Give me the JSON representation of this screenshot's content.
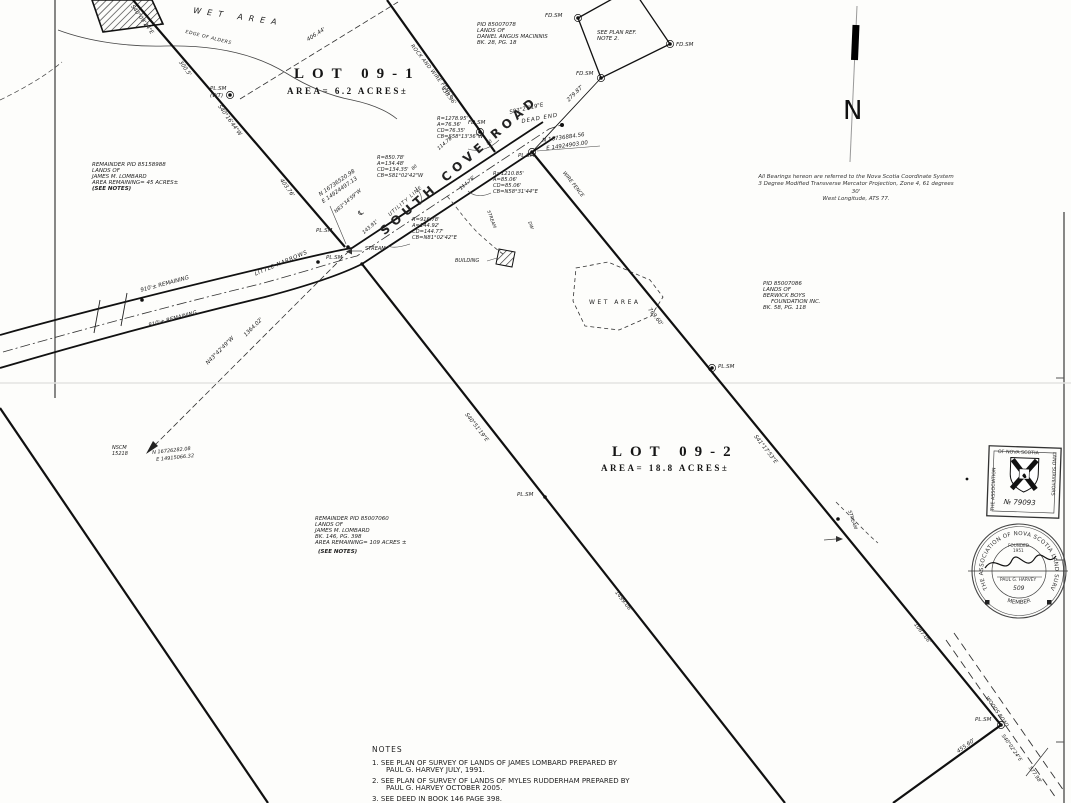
{
  "map": {
    "north_letter": "N",
    "road_name": "SOUTH  COVE  ROAD",
    "centerline_symbol": "℄",
    "lot1": {
      "title": "LOT 09-1",
      "area": "AREA= 6.2 ACRES±"
    },
    "lot2": {
      "title": "LOT 09-2",
      "area": "AREA= 18.8 ACRES±"
    }
  },
  "parcels": {
    "macinnis": [
      "PID 85007078",
      "LANDS OF",
      "DANIEL ANGUS MACINNIS",
      "BK. 28, PG. 18"
    ],
    "see_plan_ref": [
      "SEE PLAN REF.",
      "NOTE 2."
    ],
    "lombard_west": [
      "REMAINDER PID 85158988",
      "LANDS OF",
      "JAMES M. LOMBARD",
      "AREA REMAINING= 45 ACRES±",
      "(SEE NOTES)"
    ],
    "berwick": [
      "PID 85007086",
      "LANDS OF",
      "BERWICK BOYS",
      "FOUNDATION INC.",
      "BK. 58, PG. 118"
    ],
    "lombard_south": [
      "REMAINDER PID 85007060",
      "LANDS OF",
      "JAMES M. LOMBARD",
      "BK. 146, PG. 398",
      "AREA REMAINING= 109 ACRES ±",
      "(SEE NOTES)"
    ]
  },
  "curves": {
    "c1": [
      "R=1278.95'",
      "A=76.36'",
      "CD=76.35'",
      "CB=S58°13'36\"W"
    ],
    "c2": [
      "R=850.78'",
      "A=134.48'",
      "CD=134.35'",
      "CB=S81°02'42\"W"
    ],
    "c3": [
      "R=1210.85'",
      "A=85.06'",
      "CD=85.06'",
      "CB=N58°31'44\"E"
    ],
    "c4": [
      "R=916.78'",
      "A=144.92'",
      "CD=144.77'",
      "CB=N81°02'42\"E"
    ]
  },
  "coords": {
    "pt_road_end": [
      "N 16736884.56",
      "E 14924903.00"
    ],
    "pt_road_west": [
      "N 16736520.98",
      "E 14924497.13"
    ],
    "nscm_name": "NSCM",
    "nscm_number": "15218",
    "nscm_n": "N 16726282.08",
    "nscm_e": "E 14915066.32"
  },
  "features": {
    "wet_area_top": "WET AREA",
    "edge_of_alders": "EDGE OF ALDERS",
    "wet_area_east": "WET AREA",
    "little_narrows": "LITTLE NARROWS",
    "utility_line": "UTILITY LINE",
    "dead_end": "DEAD END",
    "rock_wire_fence": "ROCK AND WIRE FENCE",
    "wire_fence": "WIRE FENCE",
    "woods_road": "WOODS ROAD",
    "stream_west": "STREAM",
    "stream_mid": "STREAM",
    "stream_east": "STREAM",
    "building": "BUILDING",
    "dw": "DW",
    "rem_top": "910'± REMAINING",
    "rem_bottom": "810'± REMAINING"
  },
  "markers": {
    "plsm": "PL.SM",
    "wt": "(WT)",
    "fdsm": "FD.SM"
  },
  "dims": {
    "d406": "406.44'",
    "d300": "300.5'",
    "b_s40_09": "S40°09'24\"E",
    "b_s40_16": "S40°16'44\"W",
    "d403": "403.76'",
    "d438": "438.96'",
    "d279": "279.87'",
    "b_s83": "S83°27'19\"E",
    "d114a": "114.78'",
    "d114b": "114.78'",
    "b_n83": "N83°34'59\"W",
    "d143": "143.91'",
    "s80a": "80",
    "s80b": "80",
    "d769": "769.60'",
    "b_s41": "S41°17'53\"E",
    "b_f": "S40°51'19\"E",
    "d_f": "1499.06'",
    "d1087": "1087.06'",
    "d455": "455.60'",
    "b_woods": "S40°02'24\"E",
    "d577": "577.98'",
    "b_tie": "N43°42'49\"W",
    "d_tie": "1364.02'"
  },
  "bearings_note": [
    "All Bearings hereon are referred to the Nova Scotia Coordinate System",
    "3 Degree Modified Transverse Mercator Projection, Zone 4, 61 degrees 30'",
    "West Longitude, ATS 77."
  ],
  "notes": {
    "title": "NOTES",
    "items": [
      {
        "num": "1.",
        "l1": "SEE PLAN OF SURVEY OF LANDS OF JAMES LOMBARD PREPARED BY",
        "l2": "PAUL G. HARVEY JULY, 1991."
      },
      {
        "num": "2.",
        "l1": "SEE PLAN OF SURVEY OF LANDS OF MYLES RUDDERHAM PREPARED BY",
        "l2": "PAUL  G. HARVEY OCTOBER 2005."
      },
      {
        "num": "3.",
        "l1": "SEE DEED IN BOOK 146 PAGE 398.",
        "l2": ""
      }
    ]
  },
  "seals": {
    "square": {
      "top": "OF NOVA SCOTIA",
      "left": "THE ASSOCIATION",
      "right": "LAND SURVEYORS",
      "number": "№ 79093"
    },
    "round": {
      "rim": "THE ASSOCIATION OF NOVA SCOTIA LAND SURVEYORS",
      "bottom": "MEMBER",
      "founded": "FOUNDED",
      "year": "1951",
      "name": "PAUL G. HARVEY",
      "number": "509"
    }
  }
}
